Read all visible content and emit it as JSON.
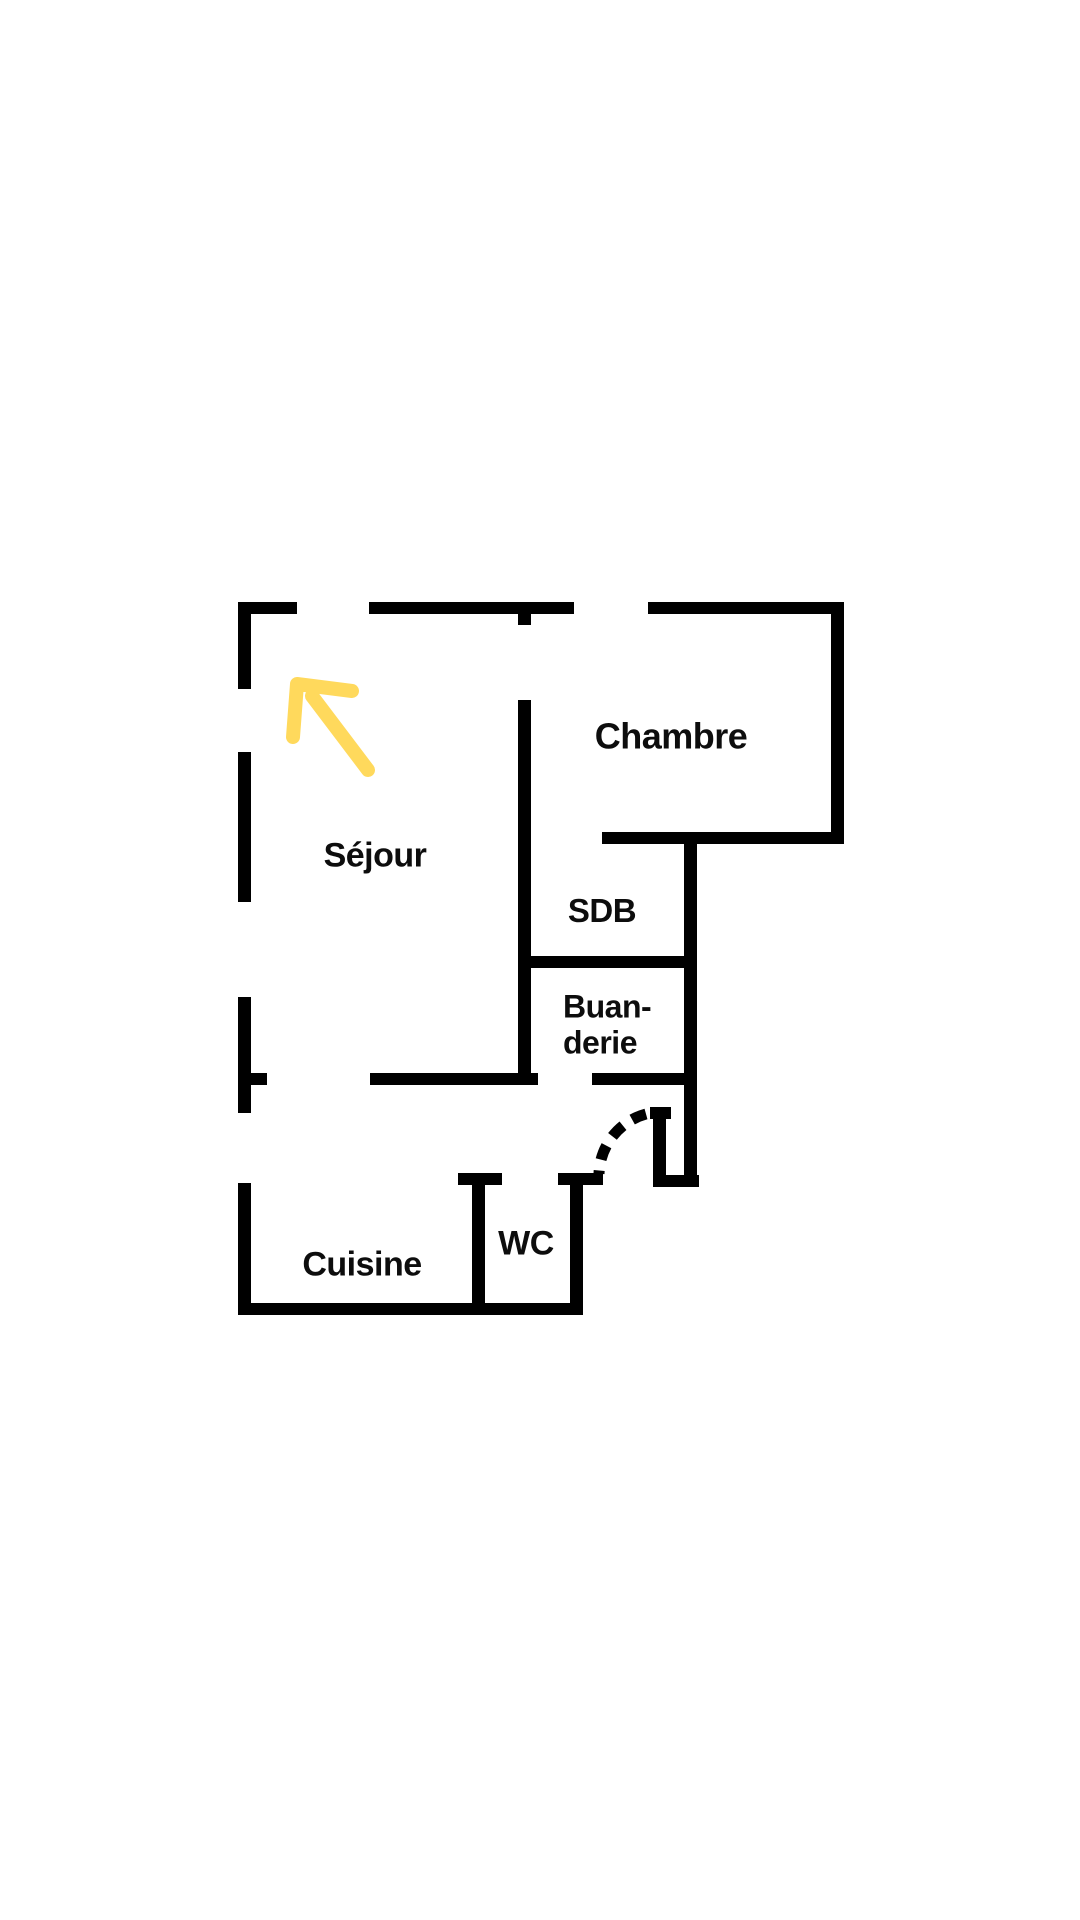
{
  "canvas": {
    "width": 1080,
    "height": 1920,
    "background": "#ffffff"
  },
  "colors": {
    "wall": "#000000",
    "label_text": "#0d0d0d",
    "arrow": "#ffd95c"
  },
  "rooms": [
    {
      "name": "sejour",
      "label": "Séjour",
      "x": 375,
      "y": 856,
      "size": 34,
      "align": "center"
    },
    {
      "name": "chambre",
      "label": "Chambre",
      "x": 671,
      "y": 736,
      "size": 36,
      "align": "center"
    },
    {
      "name": "sdb",
      "label": "SDB",
      "x": 602,
      "y": 911,
      "size": 33,
      "align": "center"
    },
    {
      "name": "buanderie",
      "label": "Buan-\nderie",
      "x": 563,
      "y": 1025,
      "size": 32,
      "align": "left"
    },
    {
      "name": "wc",
      "label": "WC",
      "x": 526,
      "y": 1244,
      "size": 34,
      "align": "center"
    },
    {
      "name": "cuisine",
      "label": "Cuisine",
      "x": 362,
      "y": 1265,
      "size": 34,
      "align": "center"
    }
  ],
  "floorplan": {
    "wall_thickness": 12,
    "walls": [
      [
        238,
        602,
        59,
        12
      ],
      [
        369,
        602,
        205,
        12
      ],
      [
        648,
        602,
        196,
        12
      ],
      [
        602,
        832,
        242,
        12
      ],
      [
        518,
        956,
        178,
        12
      ],
      [
        238,
        1073,
        29,
        12
      ],
      [
        370,
        1073,
        168,
        12
      ],
      [
        592,
        1073,
        104,
        12
      ],
      [
        458,
        1173,
        44,
        12
      ],
      [
        558,
        1173,
        45,
        12
      ],
      [
        650,
        1107,
        21,
        12
      ],
      [
        653,
        1175,
        46,
        12
      ],
      [
        238,
        1303,
        342,
        12
      ],
      [
        238,
        602,
        13,
        87
      ],
      [
        238,
        752,
        13,
        150
      ],
      [
        238,
        997,
        13,
        116
      ],
      [
        238,
        1183,
        13,
        132
      ],
      [
        518,
        602,
        13,
        23
      ],
      [
        518,
        700,
        13,
        385
      ],
      [
        684,
        832,
        13,
        355
      ],
      [
        831,
        602,
        13,
        242
      ],
      [
        472,
        1173,
        13,
        142
      ],
      [
        570,
        1173,
        13,
        142
      ],
      [
        653,
        1107,
        13,
        80
      ]
    ],
    "door_arc": {
      "path": "M 646 1114 A 64 64 0 0 0 599 1174",
      "dash": "15 11",
      "stroke_width": 11
    }
  },
  "annotations": {
    "arrow": {
      "shaft_path": "M 368 770 L 312 696",
      "head_path": "M 352 691 L 297 684 L 293 737",
      "stroke_width": 14
    }
  }
}
